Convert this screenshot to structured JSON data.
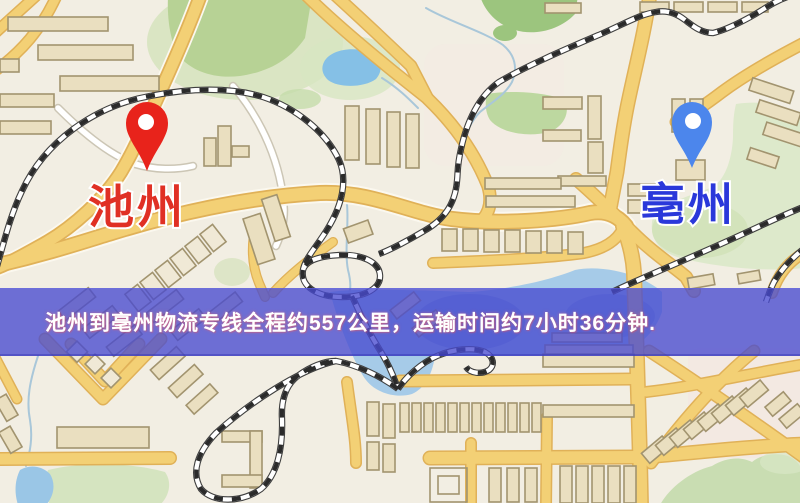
{
  "map": {
    "origin_marker": {
      "name": "池州",
      "pin_color": "#e8231b",
      "label_color": "#e03024",
      "icon": "location-pin-icon"
    },
    "destination_marker": {
      "name": "亳州",
      "pin_color": "#4c86ec",
      "label_color": "#2a38da",
      "icon": "location-pin-icon"
    },
    "info_banner": {
      "text": "池州到亳州物流专线全程约557公里，运输时间约7小时36分钟.",
      "origin": "池州",
      "destination": "亳州",
      "service": "物流专线",
      "distance": "约557公里",
      "duration": "约7小时36分钟",
      "background_color": "#484ad0",
      "text_color": "#ffffff"
    },
    "palette": {
      "background": "#f2eee3",
      "road_yellow": "#f3d075",
      "road_casing": "#e0b158",
      "road_white": "#ffffff",
      "building_fill": "#eadfc0",
      "building_stroke": "#a2946f",
      "park_green": "#b7d295",
      "park_light": "#d4e3bb",
      "water_blue": "#a6cbe8",
      "water_deep": "#7fa9dc",
      "railway_dark": "#3f3f3f",
      "railway_light": "#ffffff"
    }
  }
}
